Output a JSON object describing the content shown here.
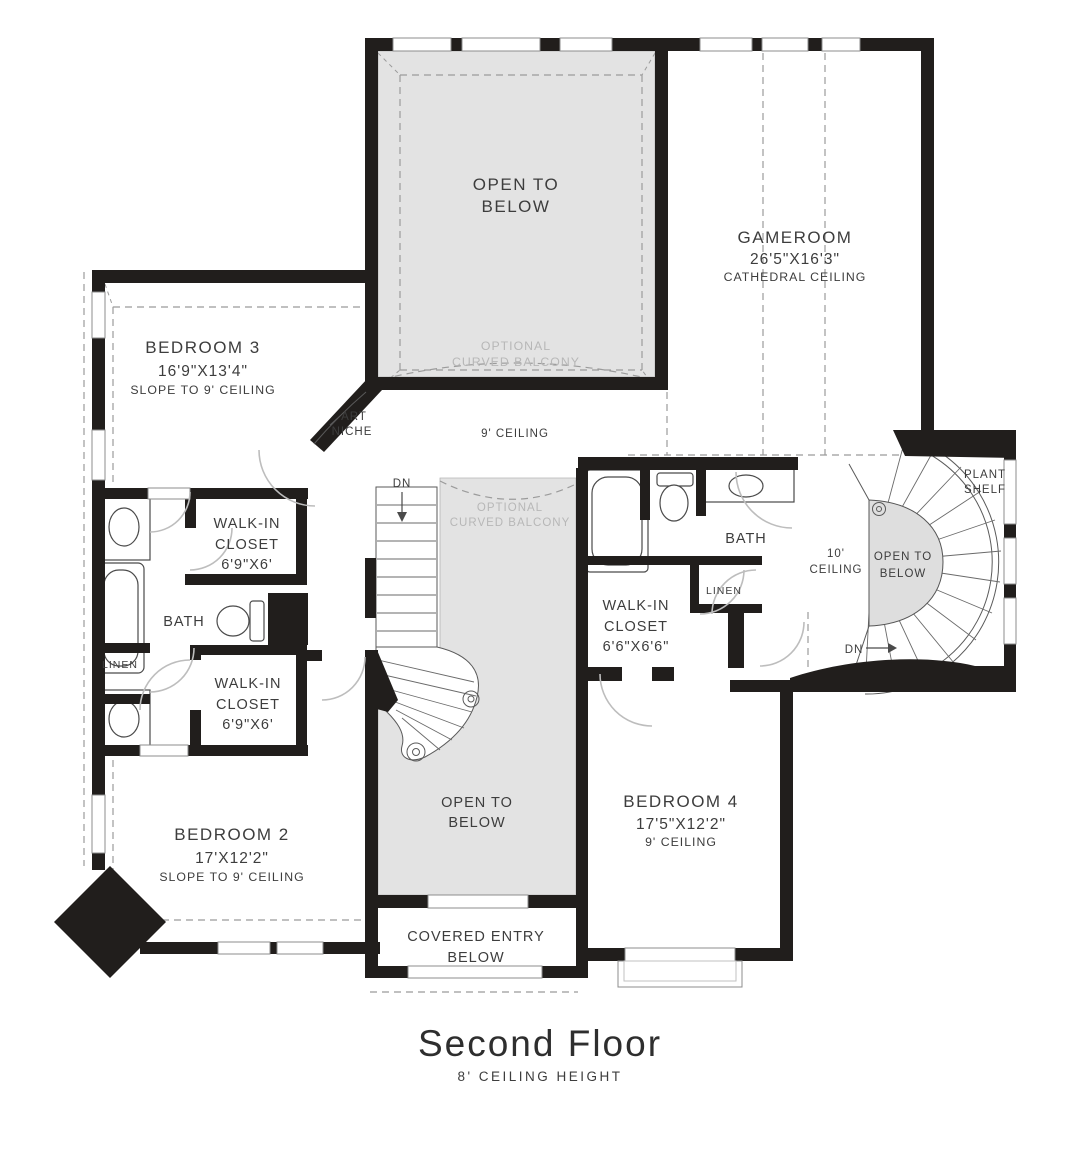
{
  "plan": {
    "title": "Second Floor",
    "subtitle": "8' CEILING HEIGHT",
    "colors": {
      "wall": "#211e1c",
      "open_area_gray": "#e3e3e3",
      "dash_gray": "#9b9b9b",
      "text": "#3d3d3d",
      "muted_text": "#b7b7b7"
    },
    "labels": {
      "open_below_top": {
        "l1": "OPEN TO",
        "l2": "BELOW"
      },
      "optional_balcony_top": {
        "l1": "OPTIONAL",
        "l2": "CURVED BALCONY"
      },
      "gameroom": {
        "name": "GAMEROOM",
        "dims": "26'5\"X16'3\"",
        "note": "CATHEDRAL CEILING"
      },
      "bedroom3": {
        "name": "BEDROOM 3",
        "dims": "16'9\"X13'4\"",
        "note": "SLOPE TO 9' CEILING"
      },
      "art_niche": {
        "l1": "ART",
        "l2": "NICHE"
      },
      "ceiling_9": "9' CEILING",
      "dn_main": "DN",
      "wic_left_upper": {
        "l1": "WALK-IN",
        "l2": "CLOSET",
        "dims": "6'9\"X6'"
      },
      "bath_left": "BATH",
      "linen_left": "LINEN",
      "wic_left_lower": {
        "l1": "WALK-IN",
        "l2": "CLOSET",
        "dims": "6'9\"X6'"
      },
      "optional_balcony_mid": {
        "l1": "OPTIONAL",
        "l2": "CURVED BALCONY"
      },
      "bath_right": "BATH",
      "linen_right": "LINEN",
      "wic_right": {
        "l1": "WALK-IN",
        "l2": "CLOSET",
        "dims": "6'6\"X6'6\""
      },
      "ceiling_10": {
        "l1": "10'",
        "l2": "CEILING"
      },
      "open_below_spiral": {
        "l1": "OPEN TO",
        "l2": "BELOW"
      },
      "plant_shelf": {
        "l1": "PLANT",
        "l2": "SHELF"
      },
      "dn_spiral": "DN",
      "bedroom2": {
        "name": "BEDROOM 2",
        "dims": "17'X12'2\"",
        "note": "SLOPE TO 9' CEILING"
      },
      "open_below_mid": {
        "l1": "OPEN TO",
        "l2": "BELOW"
      },
      "bedroom4": {
        "name": "BEDROOM 4",
        "dims": "17'5\"X12'2\"",
        "note": "9' CEILING"
      },
      "covered_entry": {
        "l1": "COVERED ENTRY",
        "l2": "BELOW"
      }
    }
  }
}
